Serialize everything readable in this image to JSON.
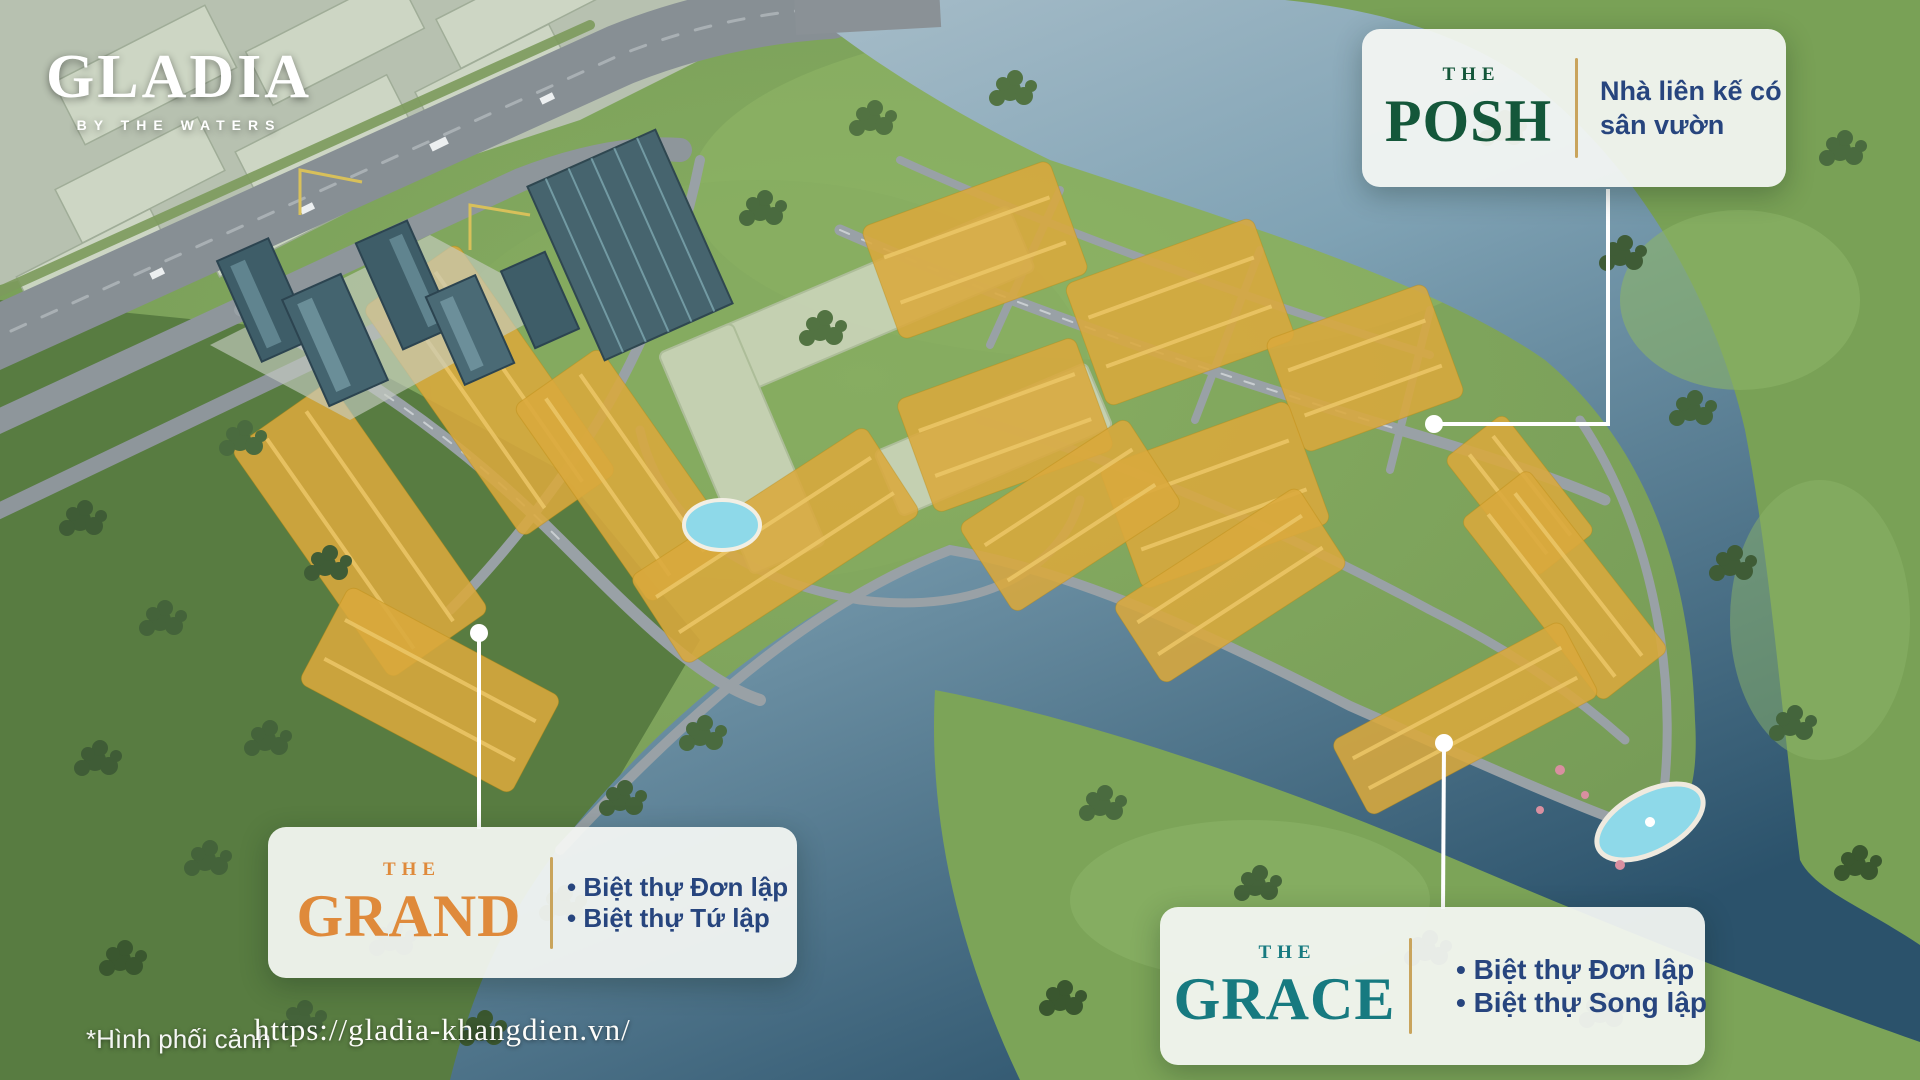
{
  "logo": {
    "title": "GLADIA",
    "tagline": "BY THE WATERS"
  },
  "callouts": [
    {
      "id": "posh",
      "kicker": "THE",
      "name": "POSH",
      "accent": "#14573A",
      "desc_lines": [
        "Nhà liên kế có",
        "sân vườn"
      ]
    },
    {
      "id": "grand",
      "kicker": "THE",
      "name": "GRAND",
      "accent": "#DF8A3B",
      "desc_lines": [
        "• Biệt thự Đơn lập",
        "• Biệt thự Tứ lập"
      ]
    },
    {
      "id": "grace",
      "kicker": "THE",
      "name": "GRACE",
      "accent": "#177A80",
      "desc_lines": [
        "• Biệt thự Đơn lập",
        "• Biệt thự Song lập"
      ]
    }
  ],
  "footer": {
    "note": "*Hình phối cảnh",
    "url": "https://gladia-khangdien.vn/"
  },
  "colors": {
    "desc_blue": "#27457E",
    "divider_gold": "#C9A45C",
    "highlight_gold": "#D9A83C",
    "water_light": "#AFC3CE",
    "water_dark": "#2E5A74",
    "land_green": "#7BA257",
    "leader_white": "#FFFFFF"
  }
}
